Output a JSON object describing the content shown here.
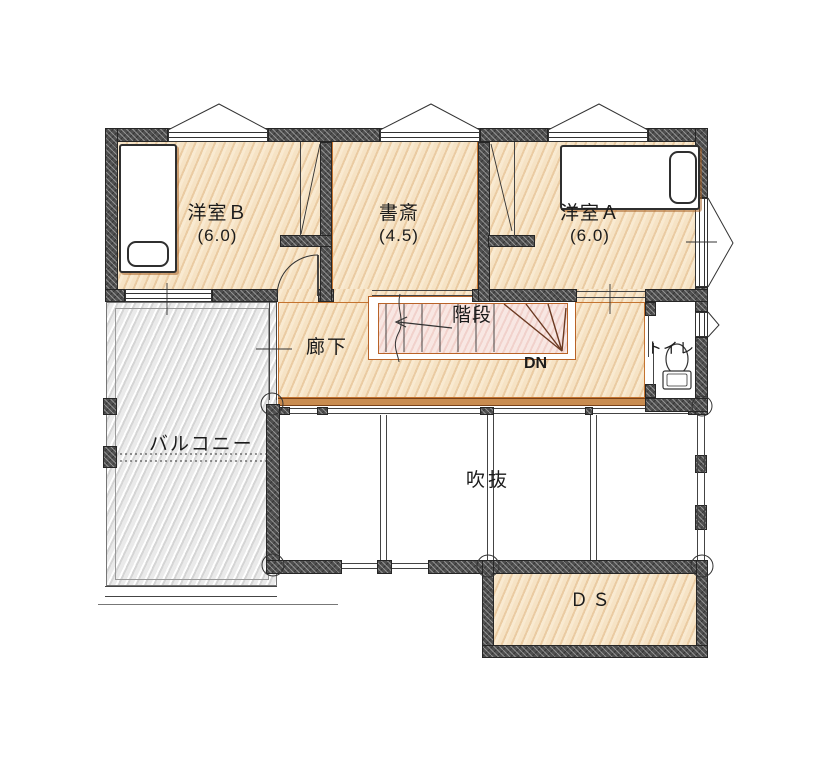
{
  "plan": {
    "type": "floor-plan-2f",
    "rooms": {
      "western_b": {
        "label": "洋室Ｂ",
        "size": "(6.0)"
      },
      "study": {
        "label": "書斎",
        "size": "(4.5)"
      },
      "western_a": {
        "label": "洋室Ａ",
        "size": "(6.0)"
      },
      "hallway": {
        "label": "廊下"
      },
      "stairs": {
        "label": "階段",
        "direction": "DN"
      },
      "toilet": {
        "label": "トイレ"
      },
      "balcony": {
        "label": "バルコニー"
      },
      "open_void": {
        "label": "吹抜"
      },
      "duct_space": {
        "label": "ＤＳ"
      }
    },
    "colors": {
      "wall": "#4f4f4f",
      "floor": "#f6e3c5",
      "floor_edge": "#c4732f",
      "stair_fill": "#f8e7e3",
      "balcony_floor": "#eaeaea",
      "line": "#333333"
    }
  }
}
